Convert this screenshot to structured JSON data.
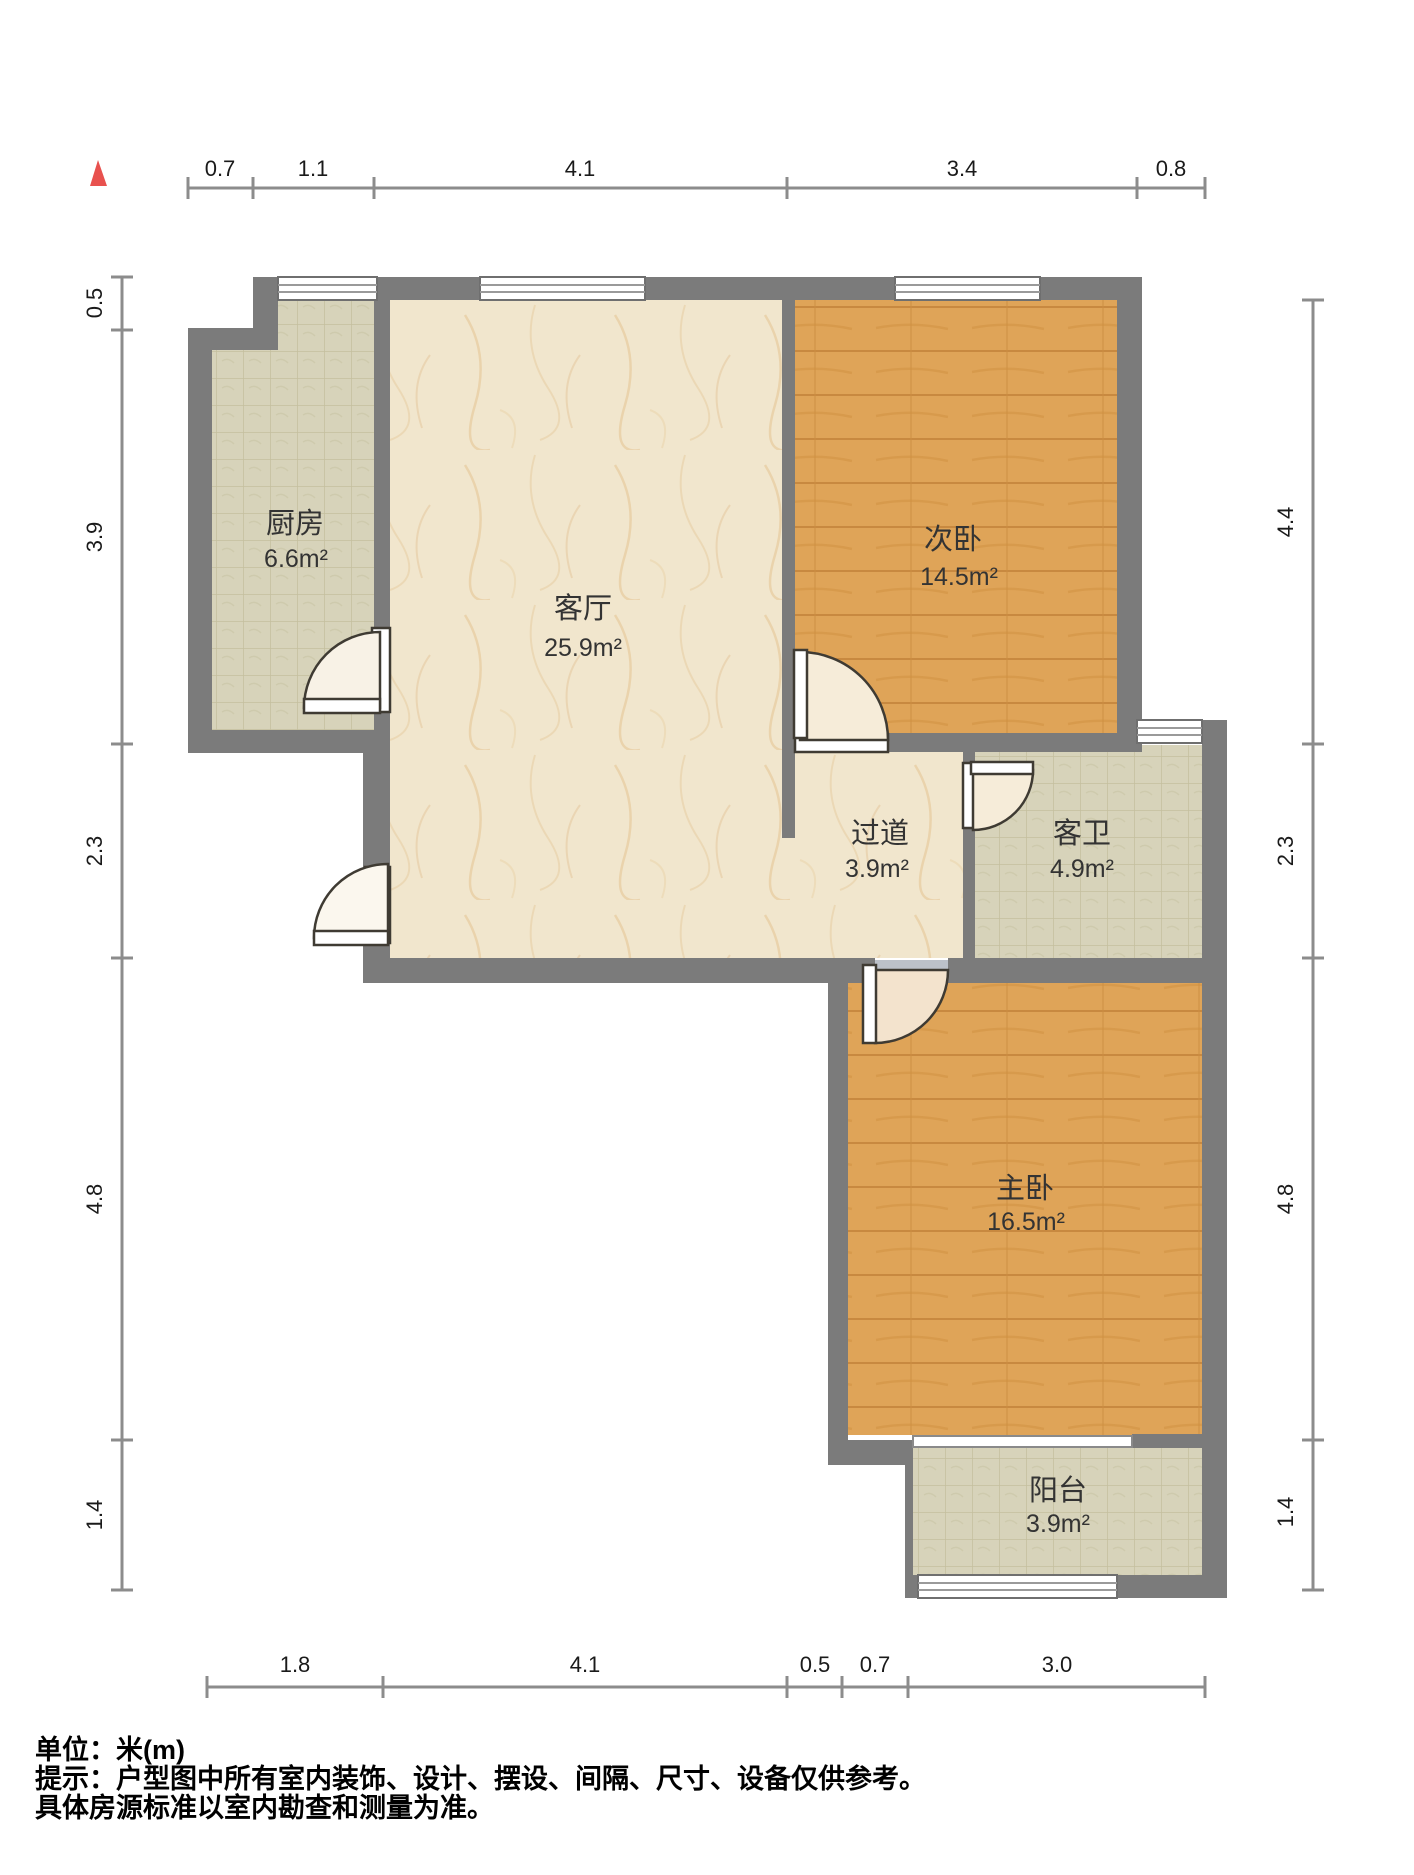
{
  "title": "户型图",
  "marker": {
    "shape": "triangle-up",
    "color": "#e8514e"
  },
  "rooms": [
    {
      "id": "kitchen",
      "name": "厨房",
      "area": "6.6m²"
    },
    {
      "id": "living",
      "name": "客厅",
      "area": "25.9m²"
    },
    {
      "id": "bedroom2",
      "name": "次卧",
      "area": "14.5m²"
    },
    {
      "id": "hallway",
      "name": "过道",
      "area": "3.9m²"
    },
    {
      "id": "bathroom",
      "name": "客卫",
      "area": "4.9m²"
    },
    {
      "id": "master",
      "name": "主卧",
      "area": "16.5m²"
    },
    {
      "id": "balcony",
      "name": "阳台",
      "area": "3.9m²"
    }
  ],
  "dimensions": {
    "top": [
      "0.7",
      "1.1",
      "4.1",
      "3.4",
      "0.8"
    ],
    "left": [
      "0.5",
      "3.9",
      "2.3",
      "4.8",
      "1.4"
    ],
    "right": [
      "4.4",
      "2.3",
      "4.8",
      "1.4"
    ],
    "bottom": [
      "1.8",
      "4.1",
      "0.5",
      "0.7",
      "3.0"
    ]
  },
  "footer": {
    "line1": "单位：米(m)",
    "line2": "提示：户型图中所有室内装饰、设计、摆设、间隔、尺寸、设备仅供参考。",
    "line3": "具体房源标准以室内勘查和测量为准。"
  },
  "colors": {
    "wall": "#7b7b7b",
    "wood_floor": "#dfa458",
    "tile_floor": "#d7d3ba",
    "marble_floor": "#f1e6cd",
    "door_fill": "#f6ecd9",
    "dim_line": "#8c8c8c",
    "marker_red": "#e8514e"
  }
}
